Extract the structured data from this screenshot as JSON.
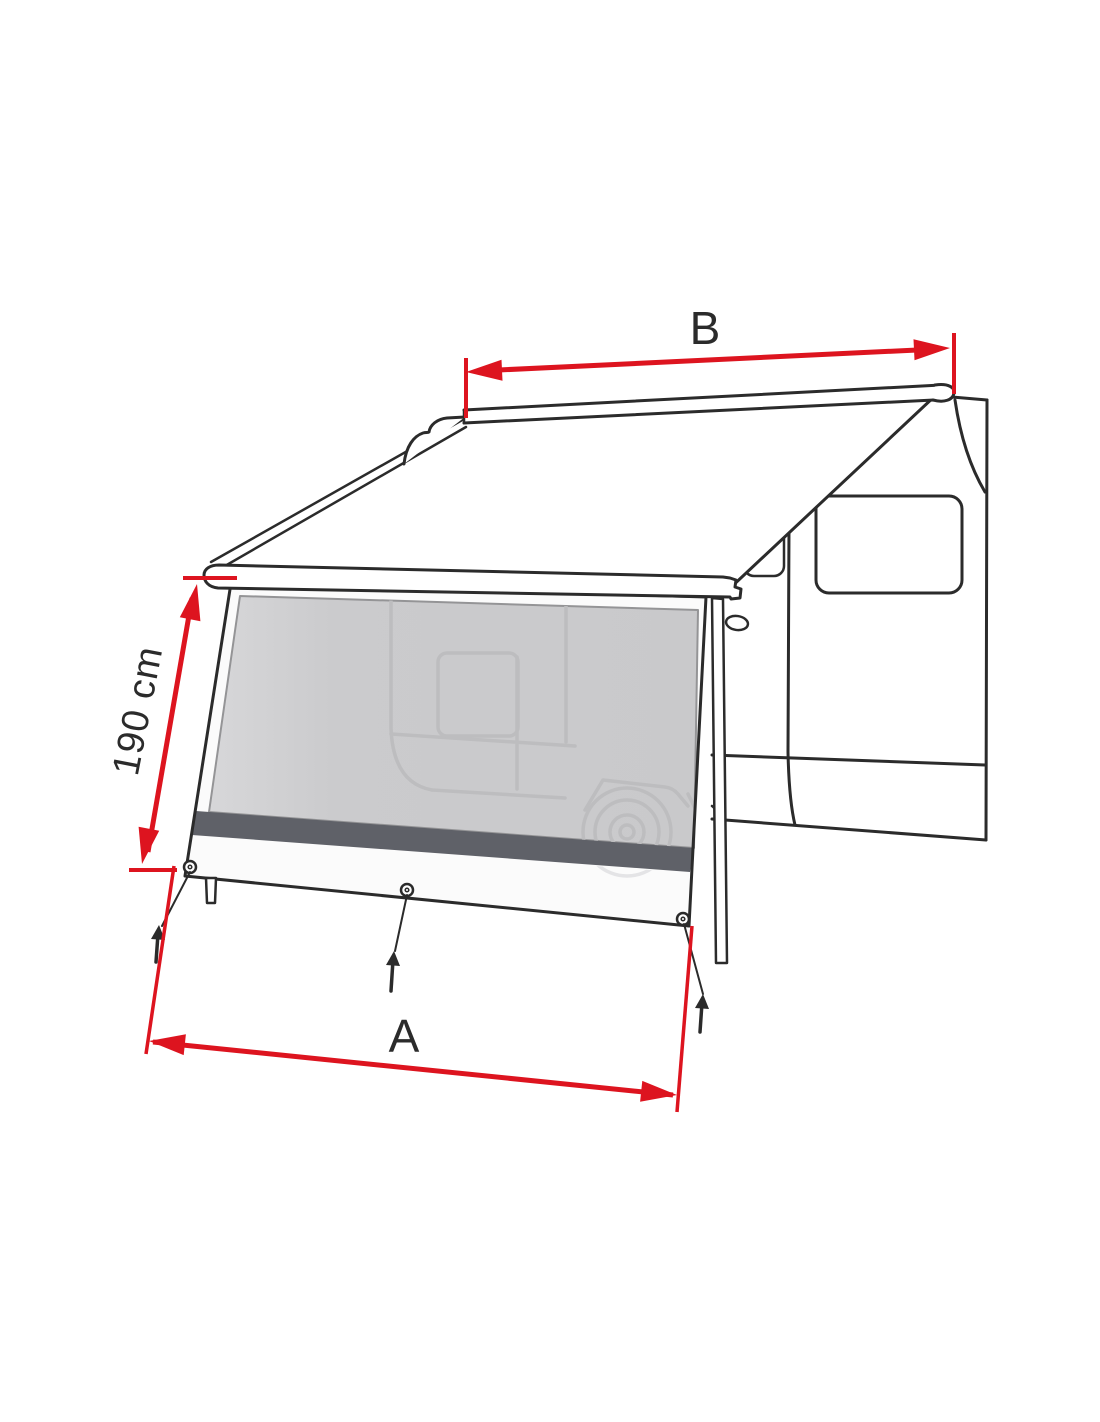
{
  "canvas": {
    "width": 1100,
    "height": 1422,
    "background": "#ffffff"
  },
  "figure": {
    "kind": "product-technical-drawing",
    "description": "Line drawing of a camper van with an extended roll-out awning and a front sun-shade panel pegged to the ground, annotated with red dimension arrows",
    "colors": {
      "outline": "#2b2b2b",
      "dimension_red": "#dd141f",
      "mesh_fill": "#cbcbcd",
      "mesh_fill_light": "#d7d7d9",
      "stripe_fill": "#5f6168",
      "silhouette": "#bdbdbf",
      "apron_fill": "#f9f9f9",
      "ghost": "#e4e4e6"
    },
    "dimensions": {
      "awning_width": {
        "label": "B"
      },
      "panel_height": {
        "label": "190 cm"
      },
      "panel_width": {
        "label": "A"
      }
    }
  }
}
